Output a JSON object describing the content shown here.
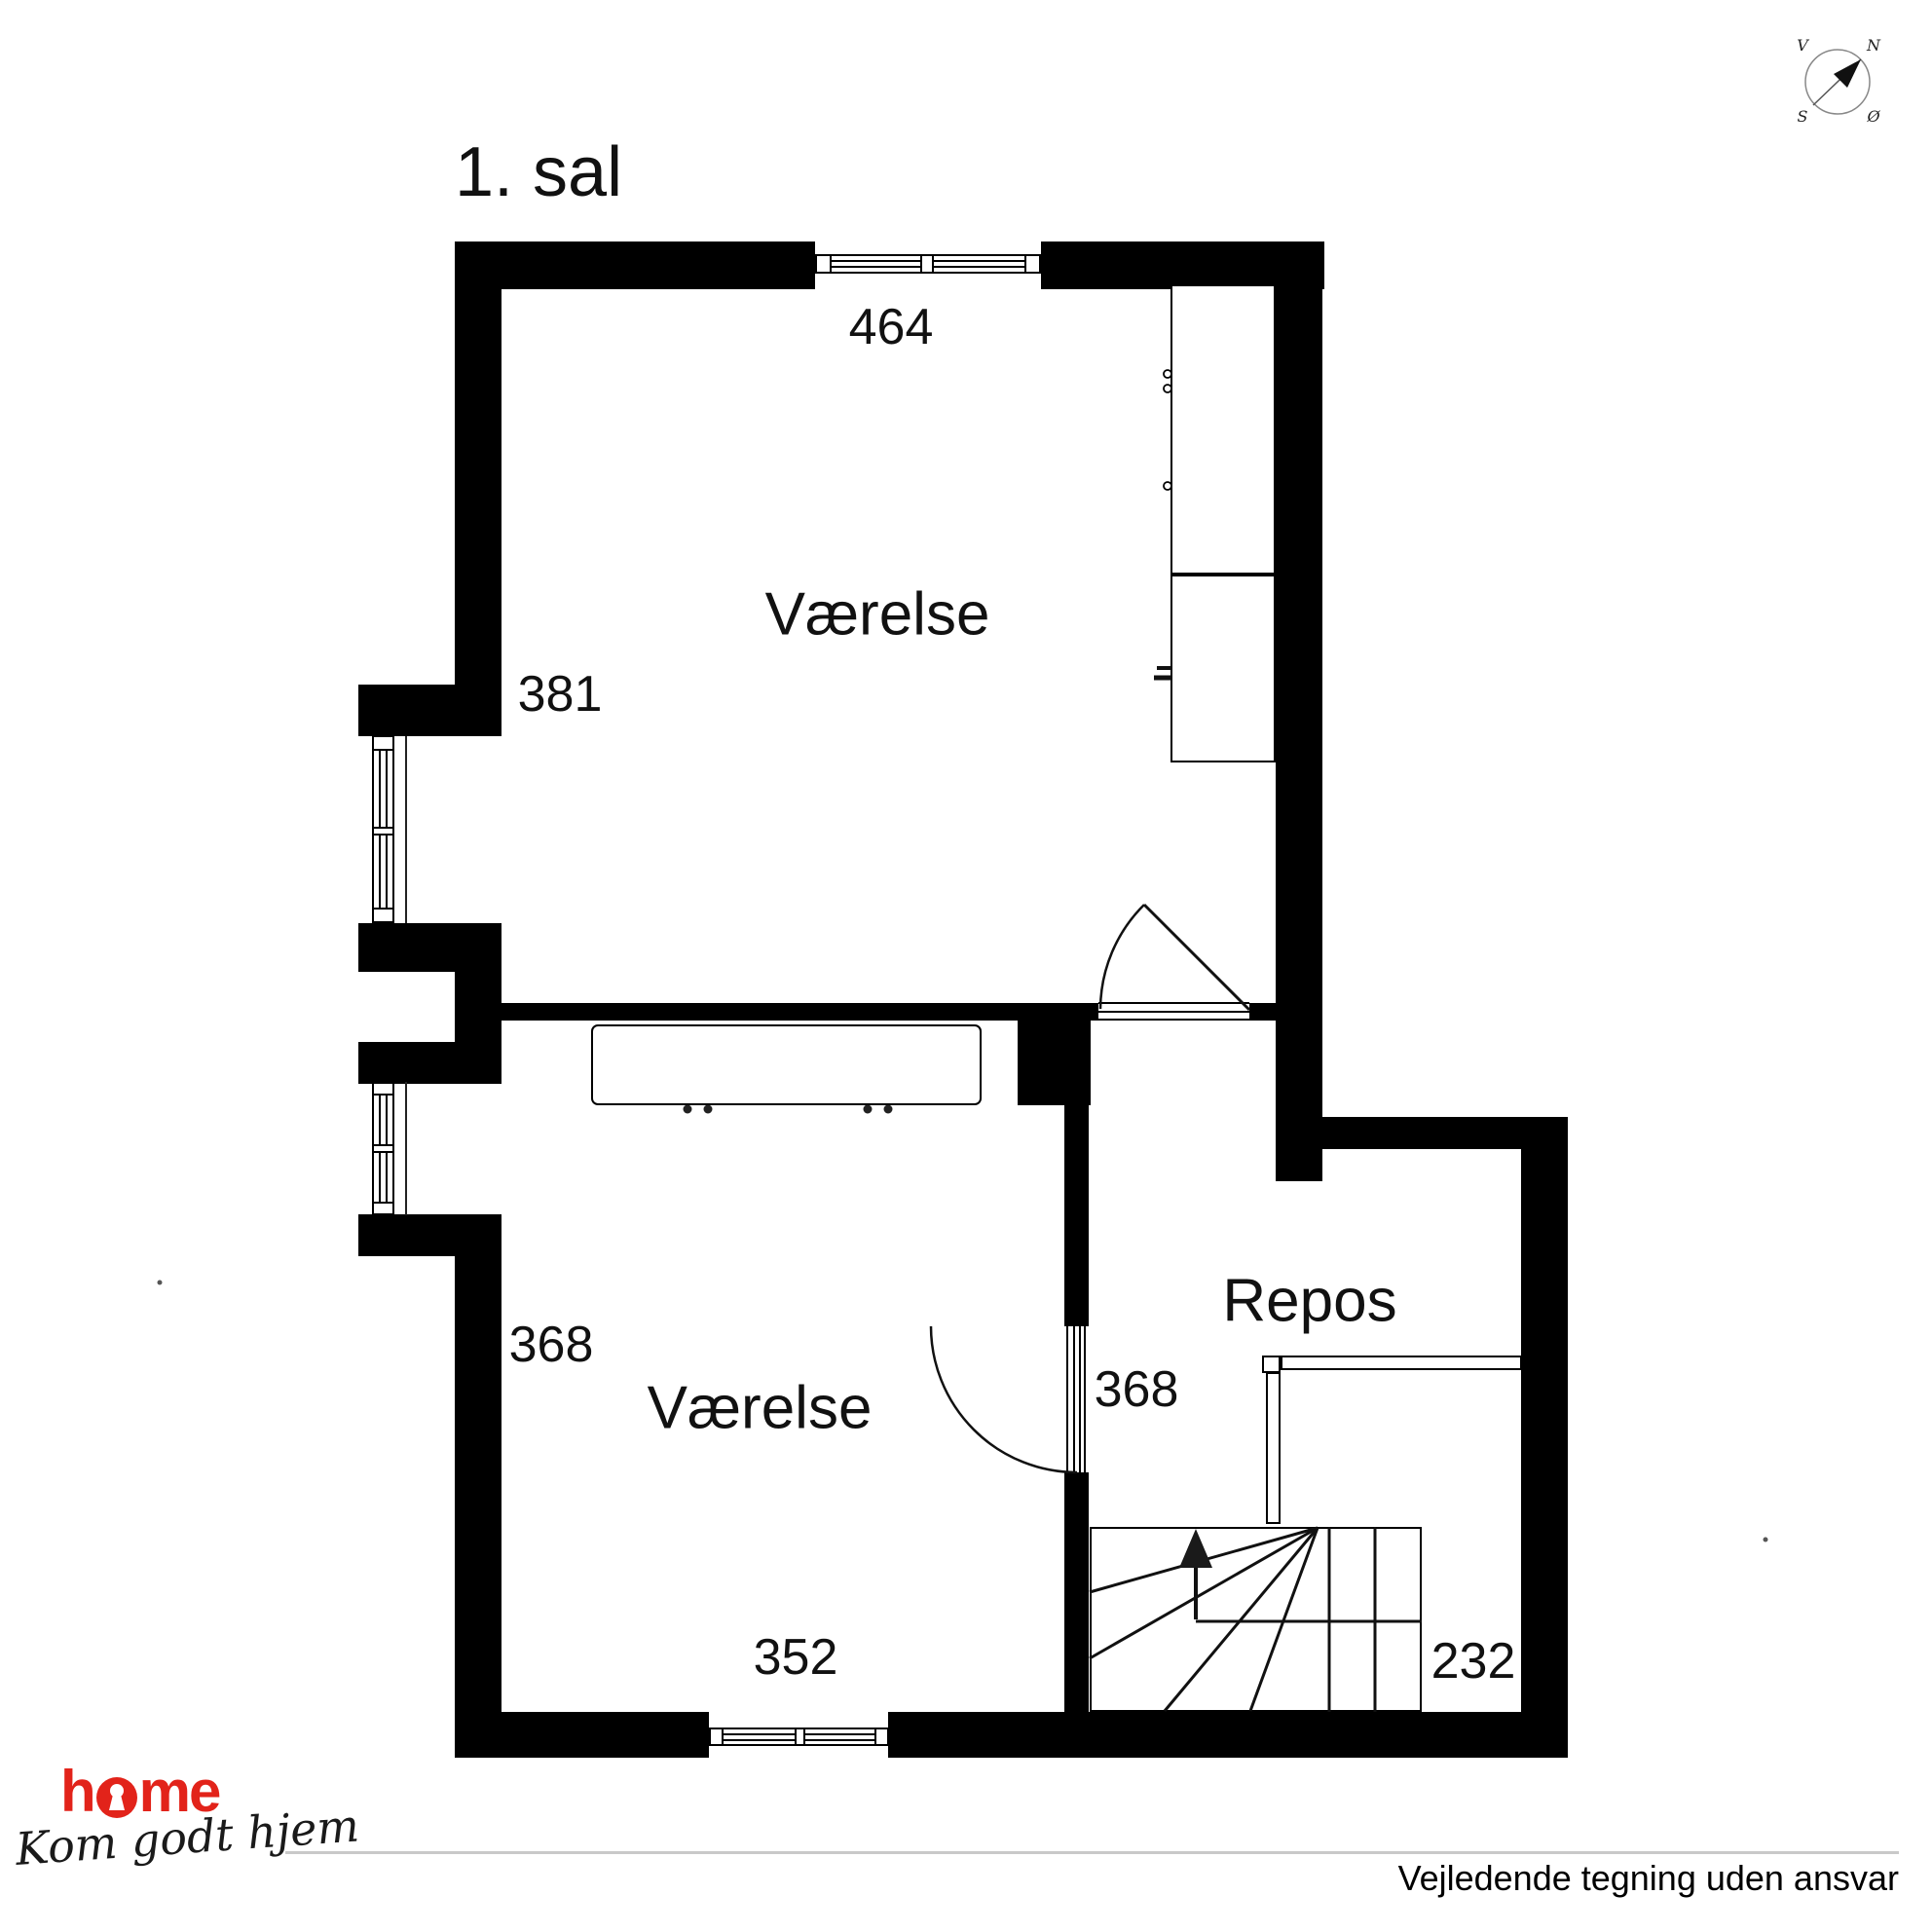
{
  "page": {
    "title": "1. sal"
  },
  "rooms": {
    "room_top": "Værelse",
    "room_bottom": "Værelse",
    "landing": "Repos"
  },
  "dimensions": {
    "top_width": "464",
    "upper_left_height": "381",
    "lower_left_height": "368",
    "door_width": "368",
    "bottom_width": "352",
    "stair_width": "232"
  },
  "compass": {
    "north": "N",
    "east": "Ø",
    "south": "S",
    "west": "V"
  },
  "footer": {
    "brand_prefix": "h",
    "brand_suffix": "me",
    "tagline": "Kom godt hjem",
    "disclaimer": "Vejledende tegning uden ansvar"
  },
  "colors": {
    "wall": "#000000",
    "brand_red": "#e2231a",
    "rule_gray": "#c9c9c9"
  }
}
